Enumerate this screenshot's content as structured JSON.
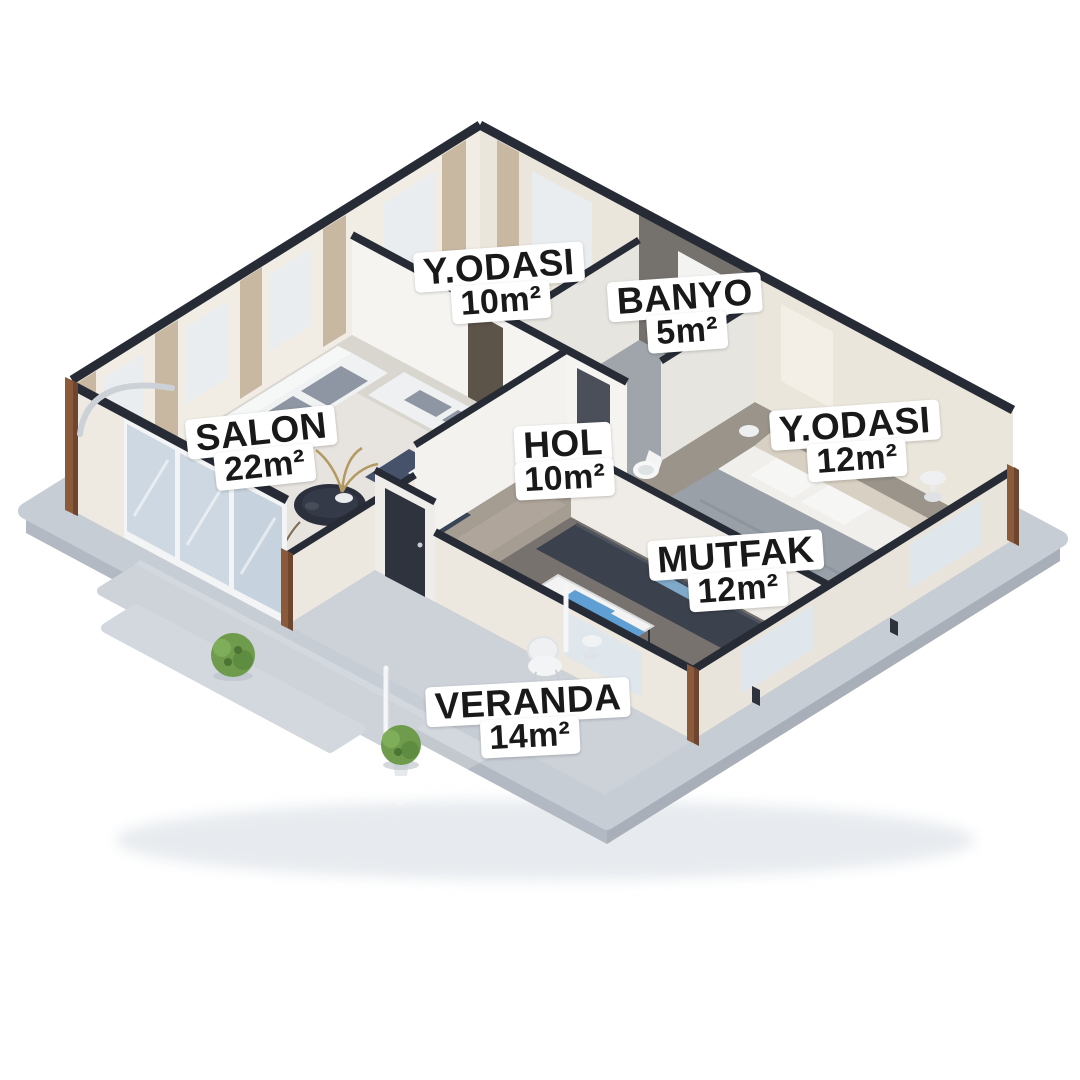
{
  "scene": {
    "type": "isometric-3d-floor-plan",
    "background": "#ffffff"
  },
  "rooms": [
    {
      "name": "Y.ODASI",
      "area": "10m²"
    },
    {
      "name": "BANYO",
      "area": "5m²"
    },
    {
      "name": "SALON",
      "area": "22m²"
    },
    {
      "name": "HOL",
      "area": "10m²"
    },
    {
      "name": "Y.ODASI",
      "area": "12m²"
    },
    {
      "name": "MUTFAK",
      "area": "12m²"
    },
    {
      "name": "VERANDA",
      "area": "14m²"
    }
  ],
  "colors": {
    "background": "#ffffff",
    "label_bg": "#ffffff",
    "label_text": "#191919",
    "wall_cream": "#f2ede4",
    "wall_top_edge": "#262b35",
    "bathroom_accent_wall": "#75716d",
    "wood_post": "#8a5a3b",
    "platform": "#c7cdd5",
    "glass": "#cdd8e2",
    "sofa_navy": "#45526a",
    "curtain_tan": "#c8b7a1",
    "plant_green": "#6f9c4c",
    "table_blue": "#5f9fd4"
  }
}
